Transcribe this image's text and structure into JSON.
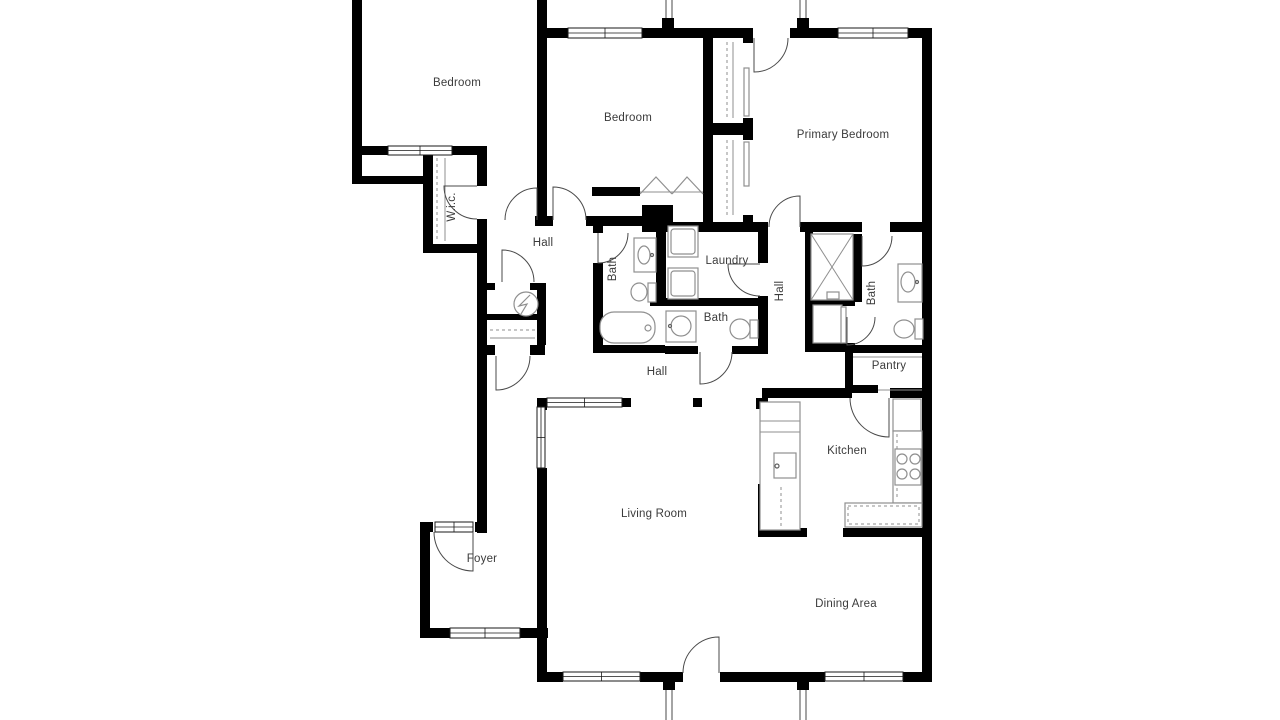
{
  "floorplan": {
    "canvas": {
      "width": 1280,
      "height": 720,
      "background": "#ffffff"
    },
    "colors": {
      "wall": "#000000",
      "door": "#4a4a4a",
      "window_stroke": "#1a1a1a",
      "fixture": "#8f8f8f",
      "fixture_dark": "#5f5f5f",
      "porch": "#4a4a4a",
      "label": "#3b3b3b"
    },
    "rooms": [
      {
        "id": "bedroom-1",
        "label": "Bedroom",
        "x": 457,
        "y": 83,
        "rotated": false
      },
      {
        "id": "bedroom-2",
        "label": "Bedroom",
        "x": 628,
        "y": 118,
        "rotated": false
      },
      {
        "id": "primary-bedroom",
        "label": "Primary Bedroom",
        "x": 843,
        "y": 135,
        "rotated": false
      },
      {
        "id": "wic",
        "label": "W.i.c.",
        "x": 452,
        "y": 207,
        "rotated": true
      },
      {
        "id": "hall-upper",
        "label": "Hall",
        "x": 543,
        "y": 243,
        "rotated": false
      },
      {
        "id": "bath-hall",
        "label": "Bath",
        "x": 613,
        "y": 269,
        "rotated": true
      },
      {
        "id": "laundry",
        "label": "Laundry",
        "x": 727,
        "y": 261,
        "rotated": false
      },
      {
        "id": "hall-bedroom",
        "label": "Hall",
        "x": 780,
        "y": 291,
        "rotated": true
      },
      {
        "id": "bath-primary",
        "label": "Bath",
        "x": 872,
        "y": 293,
        "rotated": true
      },
      {
        "id": "bath-2",
        "label": "Bath",
        "x": 716,
        "y": 318,
        "rotated": false
      },
      {
        "id": "pantry",
        "label": "Pantry",
        "x": 889,
        "y": 366,
        "rotated": false
      },
      {
        "id": "hall-main",
        "label": "Hall",
        "x": 657,
        "y": 372,
        "rotated": false
      },
      {
        "id": "kitchen",
        "label": "Kitchen",
        "x": 847,
        "y": 451,
        "rotated": false
      },
      {
        "id": "living-room",
        "label": "Living Room",
        "x": 654,
        "y": 514,
        "rotated": false
      },
      {
        "id": "foyer",
        "label": "Foyer",
        "x": 482,
        "y": 559,
        "rotated": false
      },
      {
        "id": "dining-area",
        "label": "Dining Area",
        "x": 846,
        "y": 604,
        "rotated": false
      }
    ],
    "walls": [
      [
        352,
        0,
        10,
        184
      ],
      [
        352,
        146,
        36,
        9
      ],
      [
        452,
        146,
        35,
        9
      ],
      [
        352,
        176,
        78,
        8
      ],
      [
        423,
        155,
        10,
        98
      ],
      [
        423,
        244,
        64,
        9
      ],
      [
        477,
        146,
        10,
        40
      ],
      [
        477,
        219,
        10,
        314
      ],
      [
        537,
        0,
        10,
        220
      ],
      [
        543,
        28,
        25,
        10
      ],
      [
        642,
        28,
        110,
        10
      ],
      [
        790,
        28,
        48,
        10
      ],
      [
        908,
        28,
        24,
        10
      ],
      [
        922,
        28,
        10,
        654
      ],
      [
        535,
        216,
        18,
        10
      ],
      [
        586,
        216,
        69,
        10
      ],
      [
        592,
        187,
        48,
        9
      ],
      [
        703,
        187,
        10,
        45
      ],
      [
        642,
        205,
        31,
        27
      ],
      [
        655,
        222,
        113,
        10
      ],
      [
        800,
        222,
        62,
        10
      ],
      [
        890,
        222,
        42,
        10
      ],
      [
        703,
        28,
        10,
        197
      ],
      [
        713,
        123,
        30,
        12
      ],
      [
        743,
        28,
        10,
        15
      ],
      [
        743,
        118,
        10,
        22
      ],
      [
        743,
        215,
        10,
        17
      ],
      [
        593,
        225,
        10,
        8
      ],
      [
        593,
        263,
        10,
        89
      ],
      [
        656,
        225,
        10,
        77
      ],
      [
        650,
        298,
        118,
        8
      ],
      [
        758,
        232,
        10,
        31
      ],
      [
        758,
        296,
        10,
        56
      ],
      [
        593,
        345,
        72,
        8
      ],
      [
        665,
        346,
        33,
        8
      ],
      [
        732,
        346,
        36,
        8
      ],
      [
        805,
        228,
        8,
        124
      ],
      [
        853,
        234,
        9,
        68
      ],
      [
        805,
        299,
        50,
        7
      ],
      [
        805,
        343,
        50,
        9
      ],
      [
        845,
        345,
        87,
        8
      ],
      [
        845,
        345,
        8,
        48
      ],
      [
        845,
        385,
        33,
        8
      ],
      [
        762,
        388,
        90,
        10
      ],
      [
        890,
        388,
        42,
        10
      ],
      [
        693,
        398,
        9,
        9
      ],
      [
        537,
        398,
        10,
        12
      ],
      [
        622,
        398,
        9,
        9
      ],
      [
        537,
        468,
        10,
        214
      ],
      [
        420,
        522,
        13,
        10
      ],
      [
        475,
        522,
        12,
        10
      ],
      [
        420,
        522,
        10,
        116
      ],
      [
        420,
        628,
        30,
        10
      ],
      [
        520,
        628,
        28,
        10
      ],
      [
        537,
        672,
        26,
        10
      ],
      [
        640,
        672,
        43,
        10
      ],
      [
        720,
        672,
        105,
        10
      ],
      [
        903,
        672,
        29,
        10
      ],
      [
        756,
        398,
        12,
        11
      ],
      [
        758,
        484,
        10,
        53
      ],
      [
        758,
        528,
        49,
        9
      ],
      [
        843,
        528,
        89,
        9
      ],
      [
        487,
        283,
        8,
        7
      ],
      [
        530,
        283,
        15,
        7
      ],
      [
        487,
        314,
        58,
        6
      ],
      [
        477,
        345,
        18,
        10
      ],
      [
        530,
        345,
        15,
        10
      ],
      [
        537,
        283,
        9,
        62
      ],
      [
        662,
        18,
        12,
        12
      ],
      [
        797,
        18,
        12,
        12
      ],
      [
        663,
        680,
        12,
        10
      ],
      [
        797,
        680,
        12,
        10
      ]
    ],
    "windows": [
      [
        388,
        146,
        64,
        9
      ],
      [
        568,
        28,
        74,
        10
      ],
      [
        838,
        28,
        70,
        10
      ],
      [
        537,
        407,
        8,
        61
      ],
      [
        547,
        398,
        75,
        9
      ],
      [
        450,
        628,
        70,
        10
      ],
      [
        563,
        672,
        77,
        9
      ],
      [
        825,
        672,
        78,
        9
      ],
      [
        435,
        522,
        38,
        10
      ]
    ],
    "doors": [
      {
        "n": "bedroom1-door",
        "hx": 537,
        "hy": 220,
        "r": 32,
        "lx": 537,
        "ly": 188,
        "ax": 505,
        "ay": 220,
        "sweep": 0
      },
      {
        "n": "bedroom2-door",
        "hx": 553,
        "hy": 220,
        "r": 33,
        "lx": 553,
        "ly": 187,
        "ax": 586,
        "ay": 220,
        "sweep": 1
      },
      {
        "n": "primary-patio-door",
        "hx": 754,
        "hy": 38,
        "r": 34,
        "lx": 754,
        "ly": 72,
        "ax": 788,
        "ay": 38,
        "sweep": 0
      },
      {
        "n": "primary-hall-door",
        "hx": 800,
        "hy": 227,
        "r": 31,
        "lx": 800,
        "ly": 196,
        "ax": 769,
        "ay": 227,
        "sweep": 0
      },
      {
        "n": "ensuite-bath-door",
        "hx": 862,
        "hy": 236,
        "r": 30,
        "lx": 862,
        "ly": 266,
        "ax": 892,
        "ay": 236,
        "sweep": 0
      },
      {
        "n": "linen-closet-door",
        "hx": 847,
        "hy": 317,
        "r": 28,
        "lx": 847,
        "ly": 345,
        "ax": 875,
        "ay": 317,
        "sweep": 0
      },
      {
        "n": "laundry-door",
        "hx": 760,
        "hy": 264,
        "r": 32,
        "lx": 728,
        "ly": 264,
        "ax": 760,
        "ay": 296,
        "sweep": 0
      },
      {
        "n": "hall-bath-door",
        "hx": 598,
        "hy": 233,
        "r": 30,
        "lx": 598,
        "ly": 263,
        "ax": 628,
        "ay": 233,
        "sweep": 0
      },
      {
        "n": "bath2-door",
        "hx": 700,
        "hy": 352,
        "r": 32,
        "lx": 700,
        "ly": 384,
        "ax": 732,
        "ay": 352,
        "sweep": 0
      },
      {
        "n": "wic-door",
        "hx": 477,
        "hy": 186,
        "r": 33,
        "lx": 444,
        "ly": 186,
        "ax": 477,
        "ay": 219,
        "sweep": 0
      },
      {
        "n": "hall-closet-door",
        "hx": 502,
        "hy": 282,
        "r": 32,
        "lx": 502,
        "ly": 250,
        "ax": 534,
        "ay": 282,
        "sweep": 1
      },
      {
        "n": "corridor-closet-door",
        "hx": 496,
        "hy": 356,
        "r": 34,
        "lx": 496,
        "ly": 390,
        "ax": 530,
        "ay": 356,
        "sweep": 0
      },
      {
        "n": "front-entry-door",
        "hx": 473,
        "hy": 532,
        "r": 39,
        "lx": 473,
        "ly": 571,
        "ax": 434,
        "ay": 532,
        "sweep": 1
      },
      {
        "n": "kitchen-door",
        "hx": 889,
        "hy": 398,
        "r": 39,
        "lx": 889,
        "ly": 437,
        "ax": 850,
        "ay": 398,
        "sweep": 1
      },
      {
        "n": "patio-door",
        "hx": 719,
        "hy": 673,
        "r": 36,
        "lx": 719,
        "ly": 637,
        "ax": 683,
        "ay": 673,
        "sweep": 0
      }
    ],
    "porch_lines": [
      [
        666,
        0,
        666,
        28
      ],
      [
        672,
        0,
        672,
        28
      ],
      [
        800,
        0,
        800,
        28
      ],
      [
        806,
        0,
        806,
        28
      ],
      [
        666,
        682,
        666,
        720
      ],
      [
        672,
        682,
        672,
        720
      ],
      [
        800,
        682,
        800,
        720
      ],
      [
        806,
        682,
        806,
        720
      ]
    ],
    "fixtures": [
      {
        "t": "rect",
        "n": "washer",
        "x": 668,
        "y": 226,
        "w": 30,
        "h": 31
      },
      {
        "t": "rect",
        "n": "washer-inner",
        "x": 671,
        "y": 229,
        "w": 24,
        "h": 25,
        "rx": 3
      },
      {
        "t": "rect",
        "n": "dryer",
        "x": 668,
        "y": 268,
        "w": 30,
        "h": 31
      },
      {
        "t": "rect",
        "n": "dryer-inner",
        "x": 671,
        "y": 271,
        "w": 24,
        "h": 25,
        "rx": 3
      },
      {
        "t": "rect",
        "n": "hall-bath-vanity",
        "x": 634,
        "y": 238,
        "w": 22,
        "h": 34
      },
      {
        "t": "ellipse",
        "n": "hall-bath-sink",
        "cx": 644,
        "cy": 255,
        "rx": 6,
        "ry": 9
      },
      {
        "t": "circle",
        "n": "hall-bath-faucet",
        "cx": 652,
        "cy": 255,
        "r": 1.5,
        "dark": true
      },
      {
        "t": "rect",
        "n": "hall-bath-toilet-tank",
        "x": 648,
        "y": 283,
        "w": 8,
        "h": 19
      },
      {
        "t": "ellipse",
        "n": "hall-bath-toilet-bowl",
        "cx": 639,
        "cy": 292,
        "rx": 8,
        "ry": 9
      },
      {
        "t": "rect",
        "n": "bathtub",
        "x": 600,
        "y": 312,
        "w": 55,
        "h": 31,
        "rx": 14
      },
      {
        "t": "circle",
        "n": "bathtub-faucet",
        "cx": 648,
        "cy": 328,
        "r": 3
      },
      {
        "t": "rect",
        "n": "bath2-vanity",
        "x": 666,
        "y": 311,
        "w": 30,
        "h": 31
      },
      {
        "t": "circle",
        "n": "bath2-sink",
        "cx": 681,
        "cy": 326,
        "r": 10
      },
      {
        "t": "circle",
        "n": "bath2-faucet",
        "cx": 670,
        "cy": 326,
        "r": 1.5,
        "dark": true
      },
      {
        "t": "rect",
        "n": "bath2-toilet-tank",
        "x": 750,
        "y": 320,
        "w": 8,
        "h": 18
      },
      {
        "t": "ellipse",
        "n": "bath2-toilet-bowl",
        "cx": 740,
        "cy": 329,
        "rx": 10,
        "ry": 10
      },
      {
        "t": "rect",
        "n": "shower",
        "x": 811,
        "y": 234,
        "w": 42,
        "h": 66
      },
      {
        "t": "line",
        "n": "shower-x1",
        "x1": 811,
        "y1": 234,
        "x2": 853,
        "y2": 300
      },
      {
        "t": "line",
        "n": "shower-x2",
        "x1": 853,
        "y1": 234,
        "x2": 811,
        "y2": 300
      },
      {
        "t": "rect",
        "n": "shower-head",
        "x": 827,
        "y": 292,
        "w": 12,
        "h": 7
      },
      {
        "t": "rect",
        "n": "primary-bath-vanity",
        "x": 898,
        "y": 264,
        "w": 24,
        "h": 38
      },
      {
        "t": "ellipse",
        "n": "primary-bath-sink",
        "cx": 908,
        "cy": 282,
        "rx": 7,
        "ry": 10
      },
      {
        "t": "circle",
        "n": "primary-bath-faucet",
        "cx": 917,
        "cy": 282,
        "r": 1.5,
        "dark": true
      },
      {
        "t": "rect",
        "n": "primary-toilet-tank",
        "x": 915,
        "y": 319,
        "w": 8,
        "h": 20
      },
      {
        "t": "ellipse",
        "n": "primary-toilet-bowl",
        "cx": 904,
        "cy": 329,
        "rx": 10,
        "ry": 9
      },
      {
        "t": "rect",
        "n": "linen-closet",
        "x": 813,
        "y": 305,
        "w": 29,
        "h": 38
      },
      {
        "t": "rect",
        "n": "linen-door-panel",
        "x": 841,
        "y": 307,
        "w": 5,
        "h": 36
      },
      {
        "t": "circle",
        "n": "water-heater",
        "cx": 526,
        "cy": 304,
        "r": 12
      },
      {
        "t": "path",
        "n": "water-heater-bolt",
        "d": "M530,295 L519,306 L527,304 L521,314"
      },
      {
        "t": "dash",
        "n": "hall-closet-rod",
        "x1": 490,
        "y1": 330,
        "x2": 535,
        "y2": 330
      },
      {
        "t": "line",
        "n": "hall-closet-shelf",
        "x1": 490,
        "y1": 338,
        "x2": 535,
        "y2": 338
      },
      {
        "t": "dash",
        "n": "wic-rod",
        "x1": 437,
        "y1": 158,
        "x2": 437,
        "y2": 241
      },
      {
        "t": "line",
        "n": "wic-shelf",
        "x1": 445,
        "y1": 158,
        "x2": 445,
        "y2": 241
      },
      {
        "t": "dash",
        "n": "primary-closet-rod-upper",
        "x1": 727,
        "y1": 42,
        "x2": 727,
        "y2": 118
      },
      {
        "t": "line",
        "n": "primary-closet-shelf-upper",
        "x1": 733,
        "y1": 42,
        "x2": 733,
        "y2": 118
      },
      {
        "t": "dash",
        "n": "primary-closet-rod-lower",
        "x1": 727,
        "y1": 140,
        "x2": 727,
        "y2": 215
      },
      {
        "t": "line",
        "n": "primary-closet-shelf-lower",
        "x1": 733,
        "y1": 140,
        "x2": 733,
        "y2": 215
      },
      {
        "t": "rect",
        "n": "closet-slider-upper",
        "x": 744,
        "y": 68,
        "w": 5,
        "h": 48
      },
      {
        "t": "rect",
        "n": "closet-slider-lower",
        "x": 744,
        "y": 142,
        "w": 5,
        "h": 44
      },
      {
        "t": "line",
        "n": "bedroom2-closet-track",
        "x1": 640,
        "y1": 192,
        "x2": 703,
        "y2": 192
      },
      {
        "t": "path",
        "n": "bedroom2-bifold-left",
        "d": "M640,194 L656,177 L672,194"
      },
      {
        "t": "path",
        "n": "bedroom2-bifold-right",
        "d": "M672,194 L687,177 L703,194"
      },
      {
        "t": "rect",
        "n": "kitchen-island",
        "x": 760,
        "y": 402,
        "w": 40,
        "h": 128
      },
      {
        "t": "line",
        "n": "island-line-1",
        "x1": 760,
        "y1": 421,
        "x2": 800,
        "y2": 421
      },
      {
        "t": "line",
        "n": "island-line-2",
        "x1": 760,
        "y1": 432,
        "x2": 800,
        "y2": 432
      },
      {
        "t": "rect",
        "n": "island-sink",
        "x": 774,
        "y": 453,
        "w": 22,
        "h": 25
      },
      {
        "t": "circle",
        "n": "island-faucet",
        "cx": 777,
        "cy": 466,
        "r": 2,
        "dark": true
      },
      {
        "t": "dash",
        "n": "island-counter-edge",
        "x1": 781,
        "y1": 487,
        "x2": 781,
        "y2": 526
      },
      {
        "t": "rect",
        "n": "fridge",
        "x": 893,
        "y": 399,
        "w": 28,
        "h": 32
      },
      {
        "t": "rect",
        "n": "kitchen-counter-right",
        "x": 893,
        "y": 431,
        "w": 29,
        "h": 72
      },
      {
        "t": "dash",
        "n": "kitchen-counter-right-edge",
        "x1": 897,
        "y1": 434,
        "x2": 897,
        "y2": 500
      },
      {
        "t": "rect",
        "n": "stove",
        "x": 895,
        "y": 449,
        "w": 26,
        "h": 36
      },
      {
        "t": "circle",
        "n": "stove-burner-1",
        "cx": 902,
        "cy": 459,
        "r": 5
      },
      {
        "t": "circle",
        "n": "stove-burner-2",
        "cx": 915,
        "cy": 459,
        "r": 5
      },
      {
        "t": "circle",
        "n": "stove-burner-3",
        "cx": 902,
        "cy": 474,
        "r": 5
      },
      {
        "t": "circle",
        "n": "stove-burner-4",
        "cx": 915,
        "cy": 474,
        "r": 5
      },
      {
        "t": "rect",
        "n": "kitchen-counter-bottom",
        "x": 845,
        "y": 503,
        "w": 77,
        "h": 24
      },
      {
        "t": "dashrect",
        "n": "kitchen-counter-bottom-edge",
        "x": 848,
        "y": 506,
        "w": 71,
        "h": 18
      },
      {
        "t": "line",
        "n": "pantry-shelf-1",
        "x1": 853,
        "y1": 357,
        "x2": 922,
        "y2": 357
      },
      {
        "t": "line",
        "n": "pantry-shelf-2",
        "x1": 878,
        "y1": 390,
        "x2": 922,
        "y2": 390
      }
    ]
  }
}
